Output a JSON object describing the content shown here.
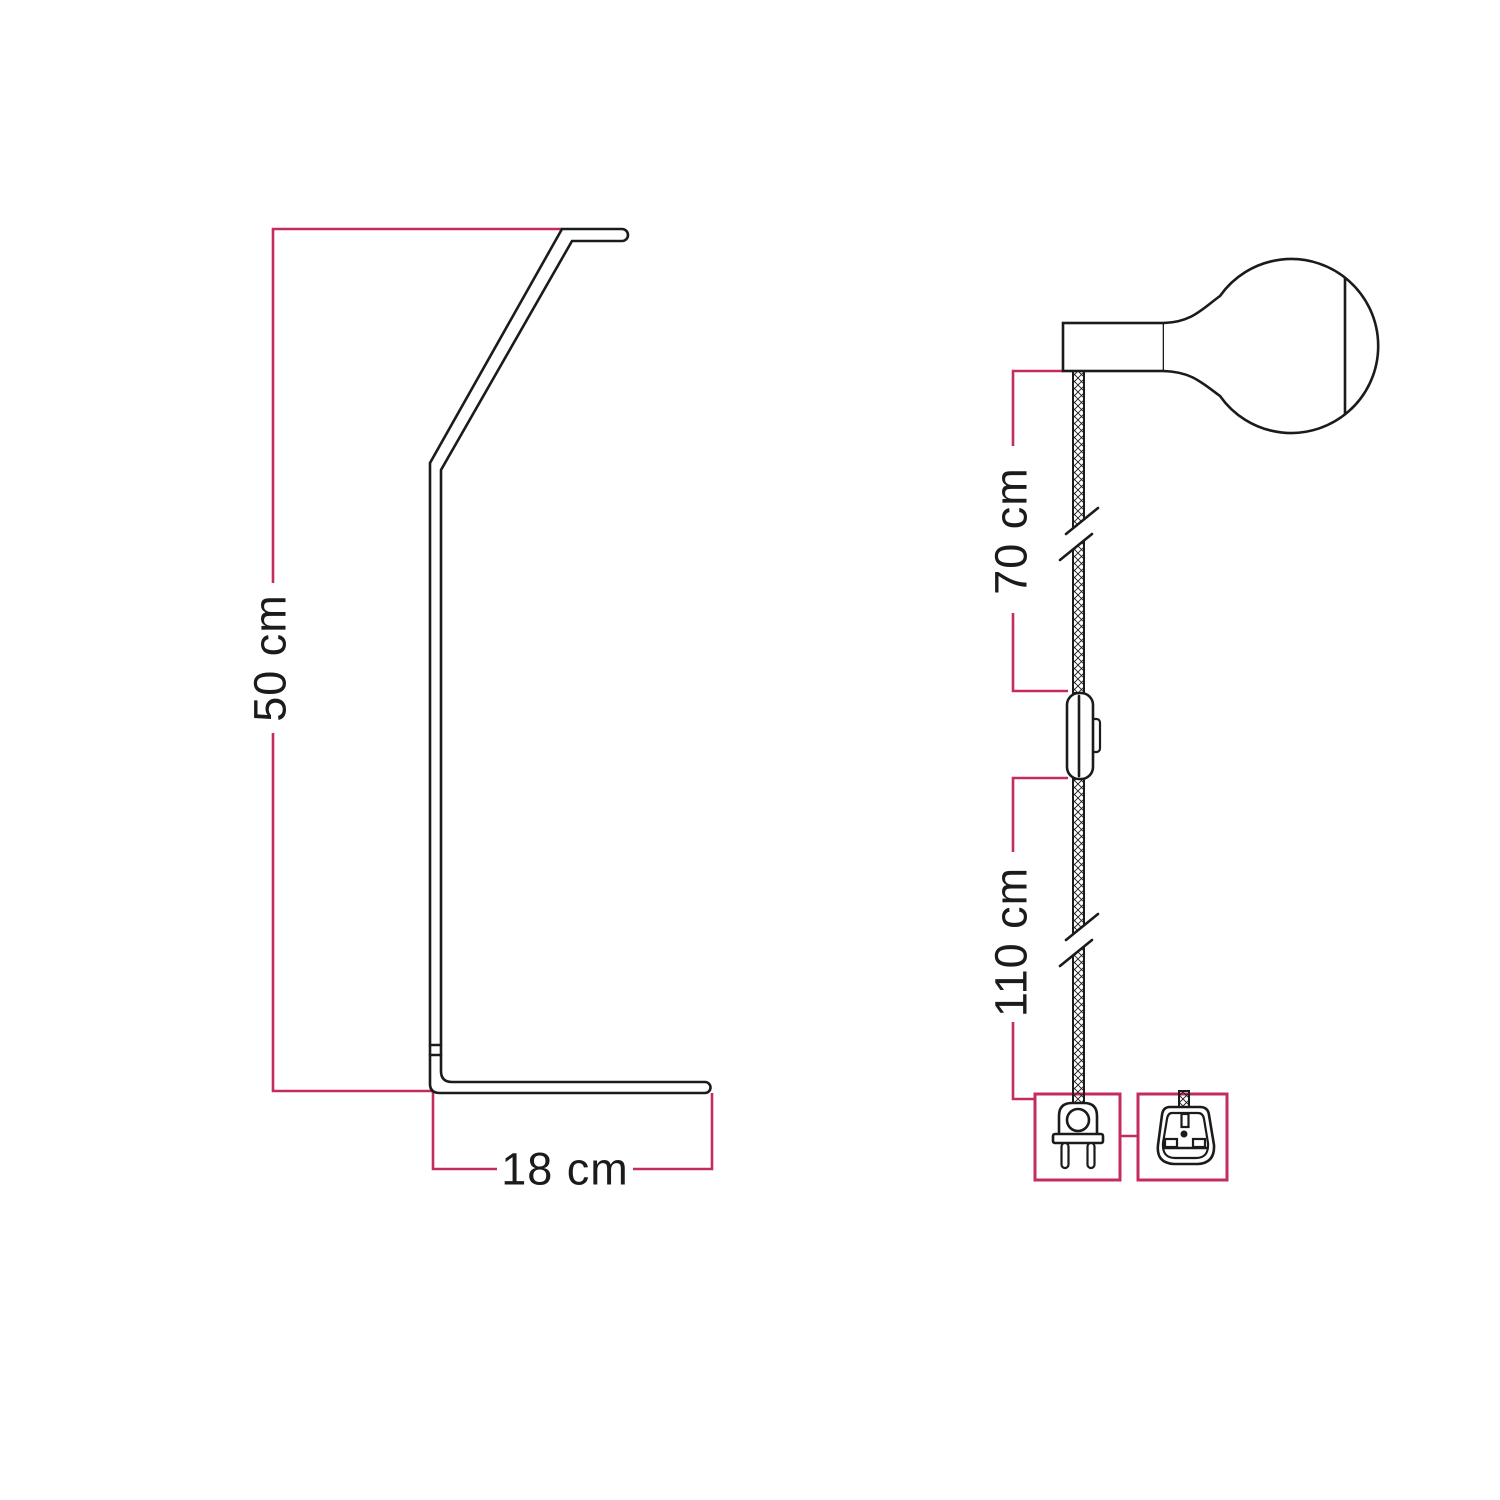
{
  "colors": {
    "line": "#1b1b1b",
    "dimension": "#c42b60",
    "background": "#ffffff"
  },
  "figures": {
    "stand": {
      "name": "lamp-stand-side-view",
      "height_label": "50 cm",
      "base_depth_label": "18 cm"
    },
    "pendant": {
      "name": "socket-cable-plug-view",
      "upper_cable_label": "70 cm",
      "lower_cable_label": "110 cm"
    }
  }
}
